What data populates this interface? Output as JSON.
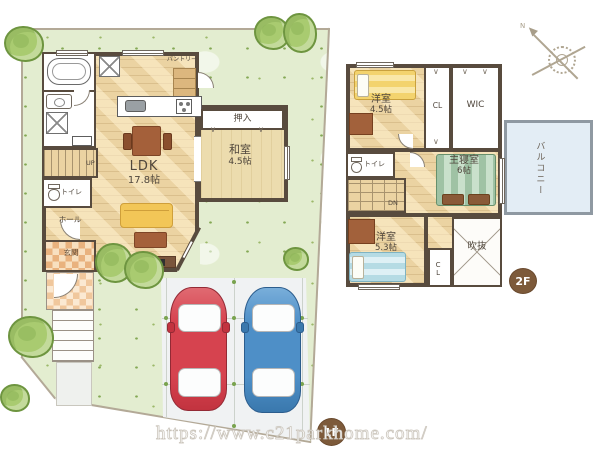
{
  "f1": {
    "badge": "1F",
    "ldk_name": "LDK",
    "ldk_size": "17.8帖",
    "washitsu_name": "和室",
    "washitsu_size": "4.5帖",
    "oshiire": "押入",
    "pantry": "パントリー",
    "toilet": "トイレ",
    "hall": "ホール",
    "genkan": "玄関",
    "stairs": "UP"
  },
  "f2": {
    "badge": "2F",
    "yoshitsu1_name": "洋室",
    "yoshitsu1_size": "4.5帖",
    "closet1": "CL",
    "wic": "WIC",
    "toilet": "トイレ",
    "master_name": "主寝室",
    "master_size": "6帖",
    "stairs": "DN",
    "yoshitsu2_name": "洋室",
    "yoshitsu2_size": "5.3帖",
    "closet2": "CL",
    "void": "吹抜",
    "balcony": "バルコニー"
  },
  "compass": {
    "north": "N"
  },
  "symbols": {
    "folding_door": "∨"
  },
  "watermark": {
    "url": "https://www.c21parkhome.com/"
  },
  "colors": {
    "lawn": "#e3edd0",
    "wood_floor": "#ebd3a2",
    "tatami": "#ecdcae",
    "wall": "#584b3e",
    "genkan_tile": "#e9b27e",
    "balcony": "#e3edf5",
    "sofa_yellow": "#f2c657",
    "car_red": "#d6434f",
    "car_blue": "#4e8fc7",
    "badge_brown": "#7d5a3a",
    "tree_green": "#a9cb70"
  }
}
